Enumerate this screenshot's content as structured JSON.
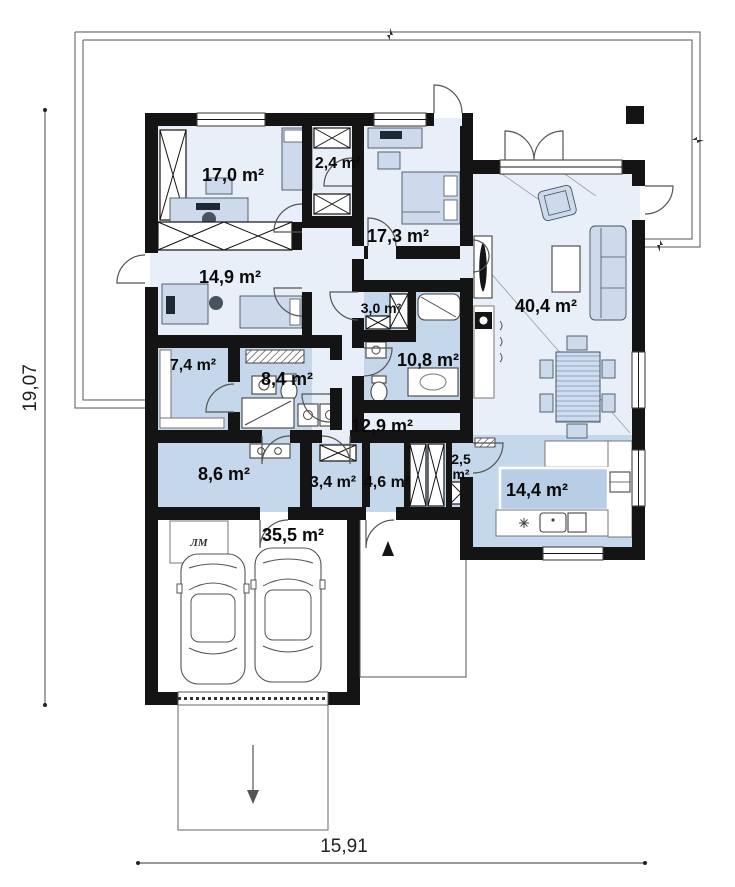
{
  "plan": {
    "dimensions": {
      "height_label": "19,07",
      "width_label": "15,91"
    },
    "garage_hatch_label": "ЛМ",
    "rooms": [
      {
        "id": "bedroom-1",
        "area_label": "17,0 m²"
      },
      {
        "id": "wardrobe-1",
        "area_label": "2,4 m²"
      },
      {
        "id": "bedroom-2",
        "area_label": "17,3 m²"
      },
      {
        "id": "bedroom-3",
        "area_label": "14,9 m²"
      },
      {
        "id": "storage",
        "area_label": "3,0 m²"
      },
      {
        "id": "living-room",
        "area_label": "40,4 m²"
      },
      {
        "id": "laundry",
        "area_label": "7,4 m²"
      },
      {
        "id": "bathroom-1",
        "area_label": "8,4 m²"
      },
      {
        "id": "bathroom-2",
        "area_label": "10,8 m²"
      },
      {
        "id": "hallway",
        "area_label": "12,9 m²"
      },
      {
        "id": "utility",
        "area_label": "8,6 m²"
      },
      {
        "id": "toilet",
        "area_label": "3,4 m²"
      },
      {
        "id": "vestibule",
        "area_label": "4,6 m²"
      },
      {
        "id": "closet",
        "area_label": "2,5 m²",
        "area_value": "2,5",
        "area_unit": "m²"
      },
      {
        "id": "kitchen",
        "area_label": "14,4 m²"
      },
      {
        "id": "garage",
        "area_label": "35,5 m²"
      }
    ],
    "colors": {
      "wall": "#141414",
      "room_light": "#e9eff8",
      "room_blue": "#c5d7ea",
      "furniture": "#ccdaec",
      "line": "#555555"
    }
  }
}
